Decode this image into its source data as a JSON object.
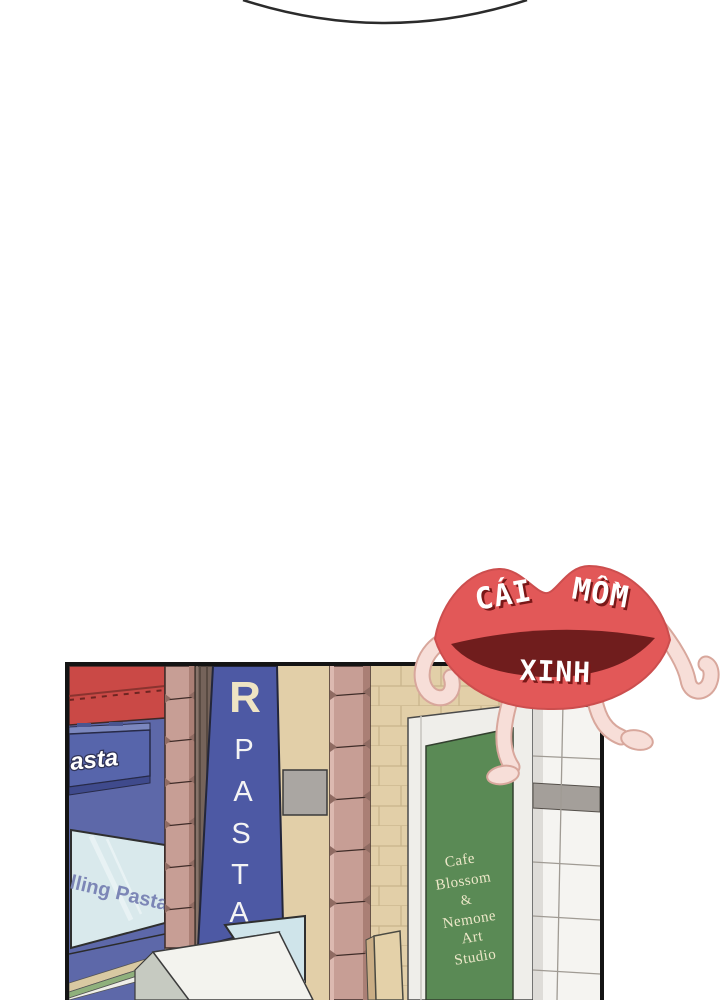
{
  "watermark": {
    "word1": "CÁI",
    "word2": "MỒM",
    "word3": "XINH",
    "lips_color": "#e25858",
    "mouth_color": "#701d1d",
    "text_color": "#ffffff",
    "text_shadow_color": "#7a1818",
    "skin_color": "#f7ded8"
  },
  "panel": {
    "wall_color": "#e2cfa8",
    "stone_color": "#c79e95",
    "pasta_shop": {
      "awning_color": "#ca4946",
      "wall_color": "#5d68a9",
      "horizontal_sign_text": "asta",
      "window_text": "lling Pasta",
      "vertical_sign": {
        "color": "#4d59a4",
        "top_letter": "R",
        "letters": [
          "P",
          "A",
          "S",
          "T",
          "A"
        ]
      }
    },
    "cafe_sign": {
      "color": "#5a8a55",
      "lines": [
        "Cafe",
        "Blossom",
        "&",
        "Nemone",
        "Art",
        "Studio"
      ]
    }
  }
}
